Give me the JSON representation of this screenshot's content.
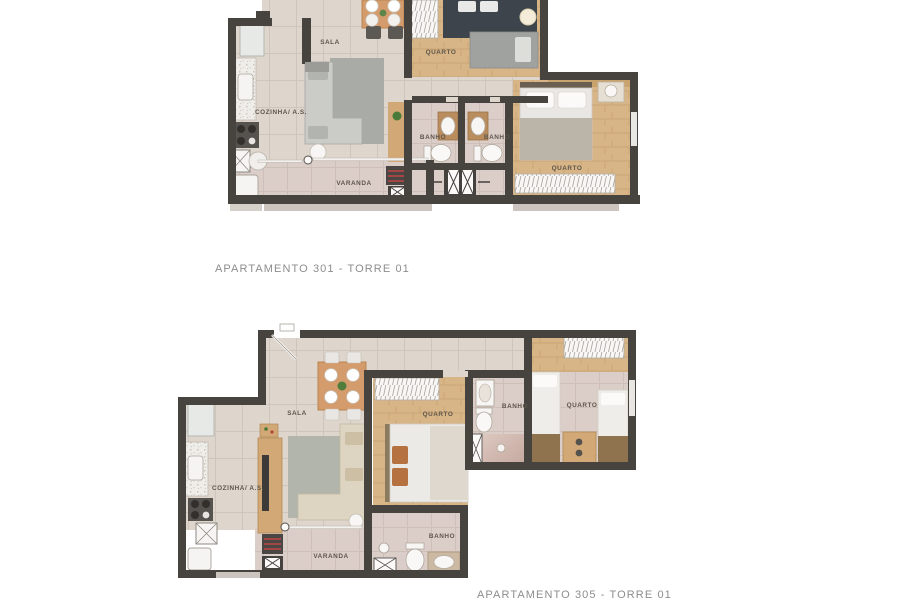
{
  "page": {
    "background": "#ffffff"
  },
  "colors": {
    "wall": "#47433f",
    "floor_tile": "#ded4cc",
    "floor_wood": "#d8b586",
    "floor_balcony": "#dccfc8",
    "rug_gray": "#a9aca6",
    "sofa_beige": "#ddd5c2",
    "accent_grill_red": "#c04545",
    "label_text": "#5e564c",
    "caption_text": "#8d8d8d"
  },
  "plans": [
    {
      "id": "plan-301",
      "caption": "APARTAMENTO 301 - TORRE 01",
      "rooms": [
        {
          "label": "SALA",
          "x": 330,
          "y": 44
        },
        {
          "label": "COZINHA/ A.S.",
          "x": 281,
          "y": 114
        },
        {
          "label": "QUARTO",
          "x": 441,
          "y": 54
        },
        {
          "label": "BANHO",
          "x": 433,
          "y": 139
        },
        {
          "label": "BANHO",
          "x": 497,
          "y": 139
        },
        {
          "label": "QUARTO",
          "x": 567,
          "y": 170
        },
        {
          "label": "VARANDA",
          "x": 354,
          "y": 185
        }
      ]
    },
    {
      "id": "plan-305",
      "caption": "APARTAMENTO 305 - TORRE 01",
      "rooms": [
        {
          "label": "SALA",
          "x": 297,
          "y": 415
        },
        {
          "label": "COZINHA/ A.S.",
          "x": 238,
          "y": 490
        },
        {
          "label": "QUARTO",
          "x": 438,
          "y": 416
        },
        {
          "label": "BANHO",
          "x": 515,
          "y": 408
        },
        {
          "label": "QUARTO",
          "x": 582,
          "y": 407
        },
        {
          "label": "VARANDA",
          "x": 331,
          "y": 558
        },
        {
          "label": "BANHO",
          "x": 442,
          "y": 538
        }
      ]
    }
  ]
}
